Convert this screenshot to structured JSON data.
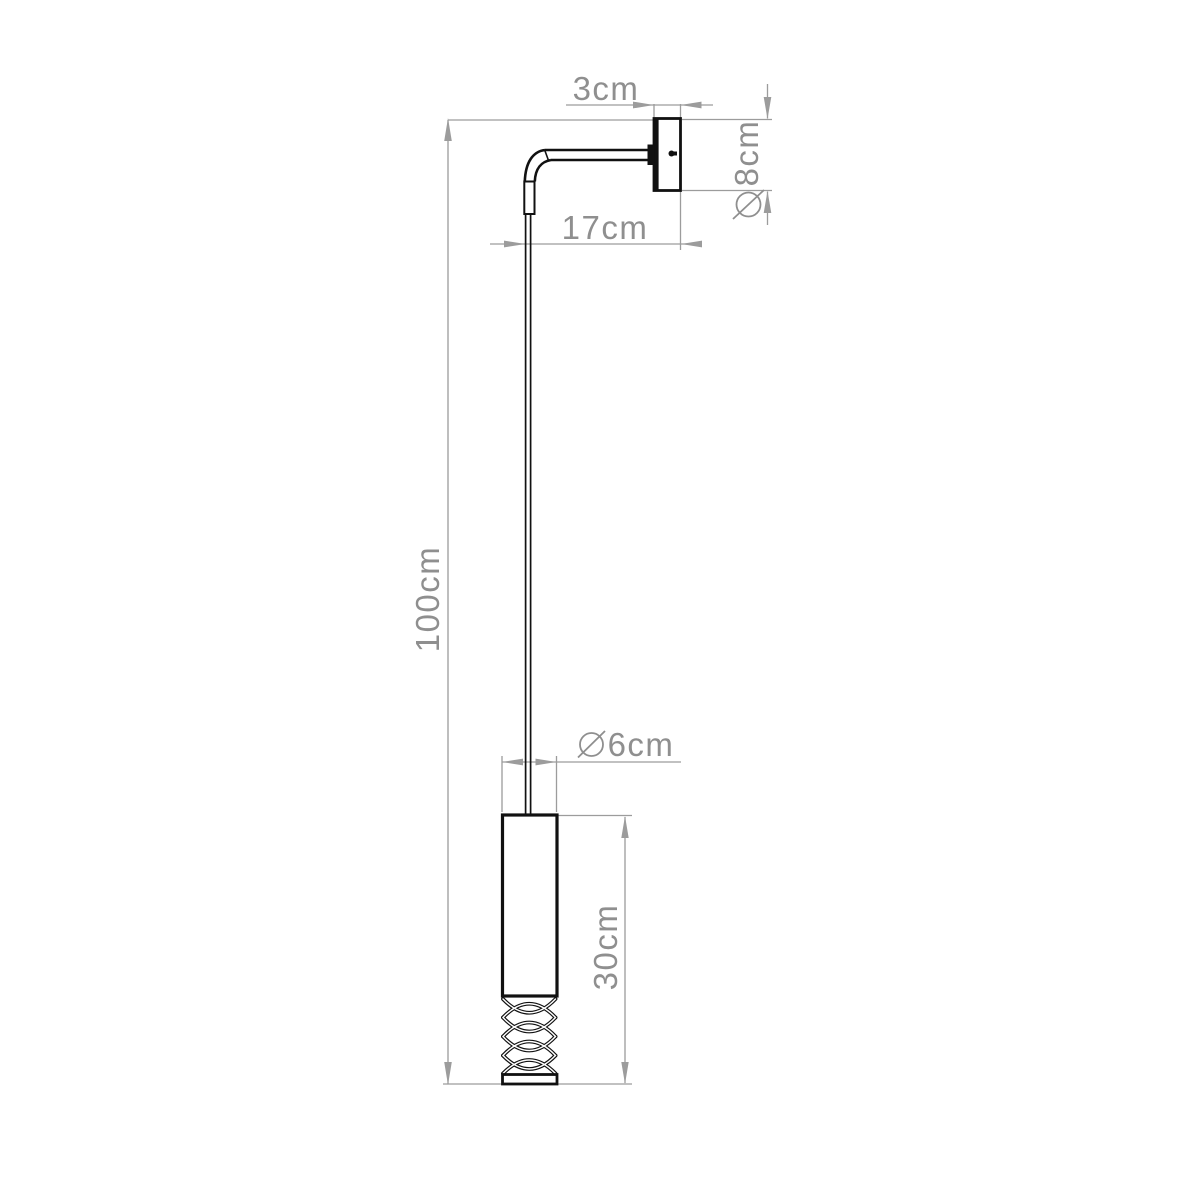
{
  "page": {
    "background": "#ffffff"
  },
  "drawing": {
    "kind": "dimensioned technical line drawing",
    "subject": "wall lamp with hanging cylindrical shade",
    "colors": {
      "object_line": "#111111",
      "dimension_line": "#9c9c9c",
      "label_text": "#8f8f8f",
      "background": "#ffffff"
    },
    "dimensions": {
      "plate_depth": {
        "label": "3cm"
      },
      "plate_diameter": {
        "label": "8cm",
        "symbol": "⌀"
      },
      "arm_reach": {
        "label": "17cm"
      },
      "hanging_height": {
        "label": "100cm"
      },
      "shade_diameter": {
        "label": "6cm",
        "symbol": "⌀"
      },
      "shade_length": {
        "label": "30cm"
      }
    }
  }
}
